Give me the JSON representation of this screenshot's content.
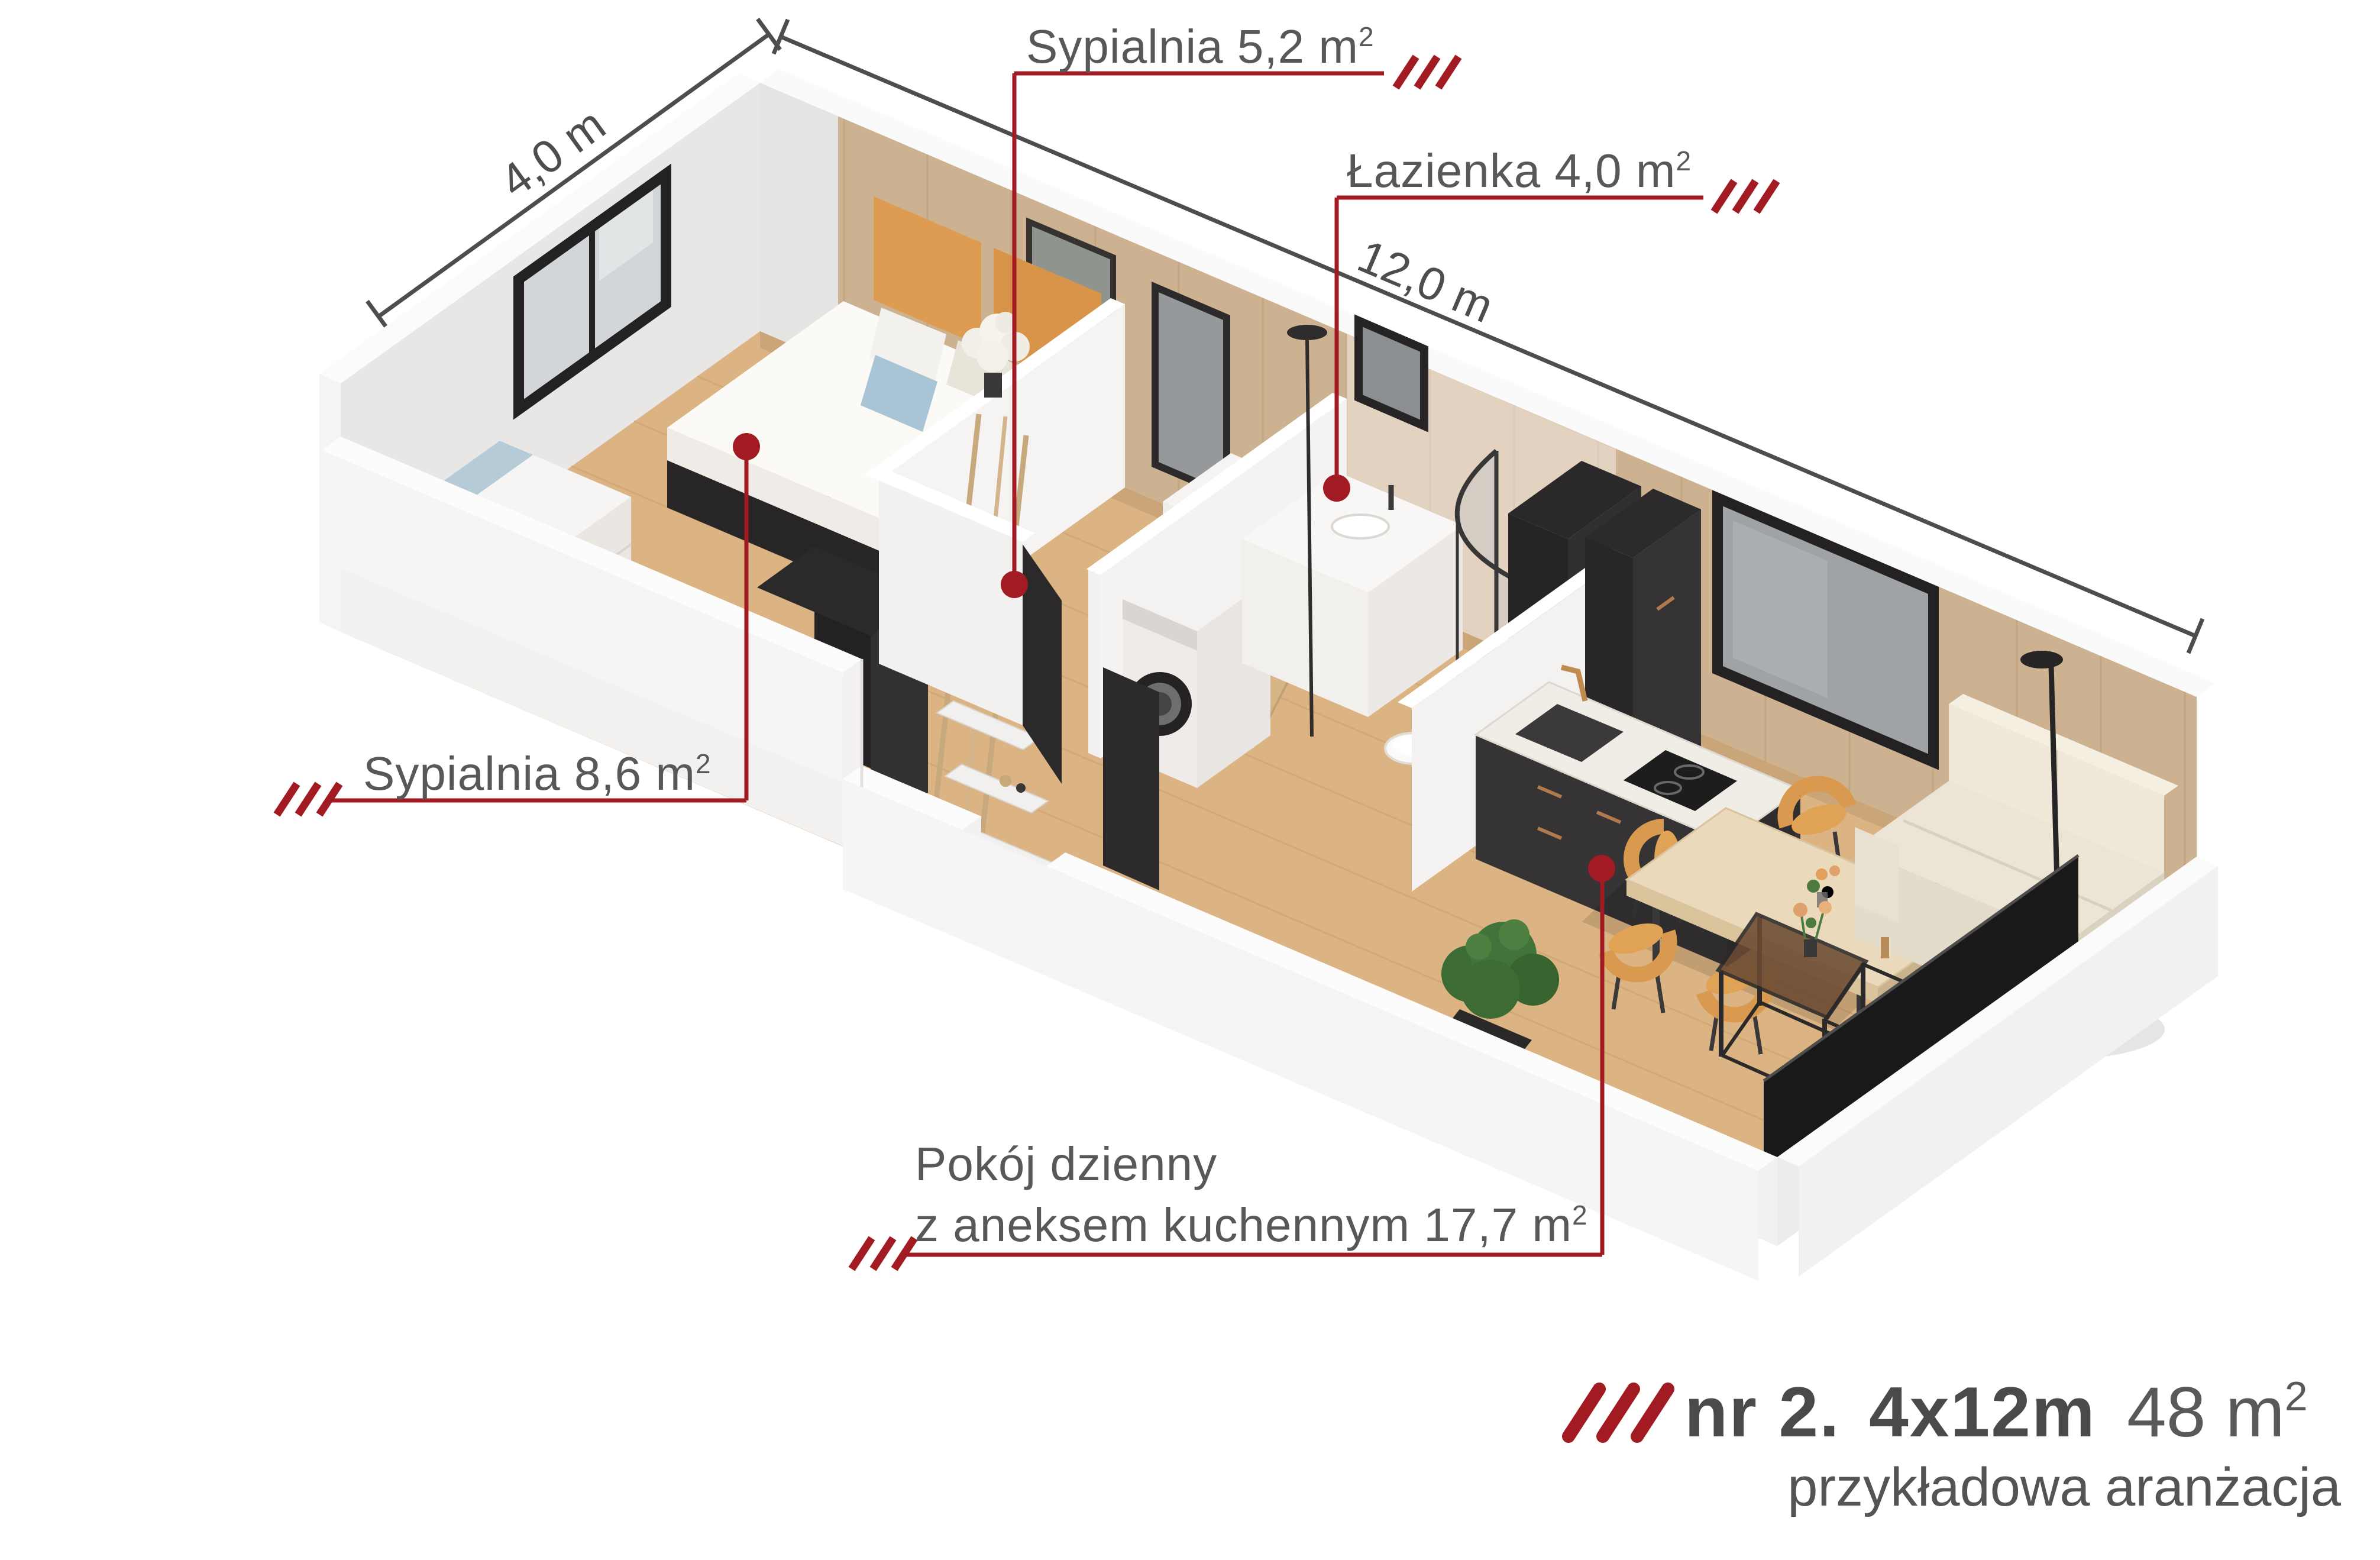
{
  "labels": {
    "bedroom_small": {
      "text": "Sypialnia 5,2 m",
      "sup": "2"
    },
    "bathroom": {
      "text": "Łazienka 4,0 m",
      "sup": "2"
    },
    "bedroom_large": {
      "text": "Sypialnia 8,6 m",
      "sup": "2"
    },
    "living": {
      "line1": "Pokój dzienny",
      "line2": "z aneksem kuchennym 17,7 m",
      "sup": "2"
    }
  },
  "dimensions": {
    "width_label": "4,0 m",
    "length_label": "12,0 m"
  },
  "title": {
    "number": "nr 2.",
    "size": "4x12m",
    "area": "48 m",
    "area_sup": "2",
    "subtitle": "przykładowa aranżacja"
  },
  "colors": {
    "accent_red": "#a31b22",
    "label_gray": "#58585a",
    "dimension_gray": "#4d4d4f",
    "title_gray": "#4a4a4c",
    "wood_floor": "#dcb382",
    "wood_wall": "#cdb291",
    "wall_white": "#f3f1f0",
    "dark_furniture": "#2a2829",
    "chair_orange": "#d9994e"
  }
}
